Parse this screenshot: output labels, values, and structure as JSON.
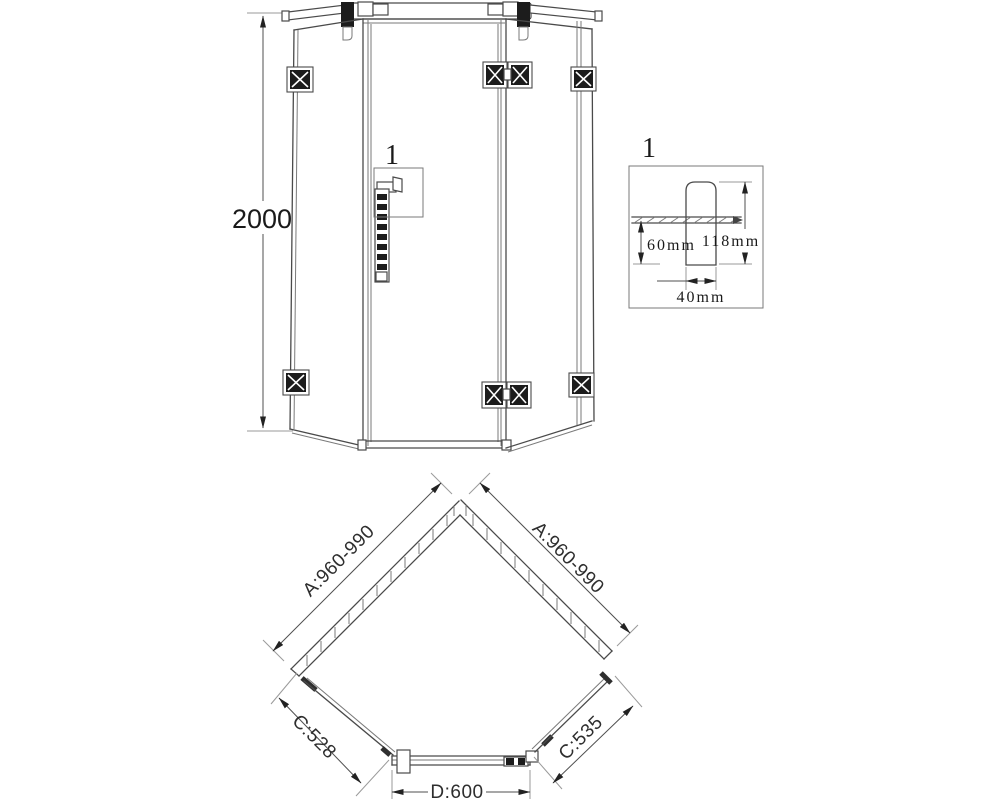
{
  "front_view": {
    "height_dim_label": "2000",
    "handle_callout_label": "1"
  },
  "detail_view": {
    "title_label": "1",
    "glass_to_end_dim": "60mm",
    "overall_height_dim": "118mm",
    "width_dim": "40mm"
  },
  "plan_view": {
    "left_wall_dim": "A:960-990",
    "right_wall_dim": "A:960-990",
    "left_glass_dim": "C:528",
    "right_glass_dim": "C:535",
    "door_width_dim": "D:600"
  },
  "colors": {
    "outline": "#4a4a4a",
    "dimension_line": "#4f4f4f",
    "extension_line": "#9a9a9a",
    "hinge_fill": "#1c1c1c",
    "text": "#1a1a1a",
    "background": "#ffffff"
  }
}
